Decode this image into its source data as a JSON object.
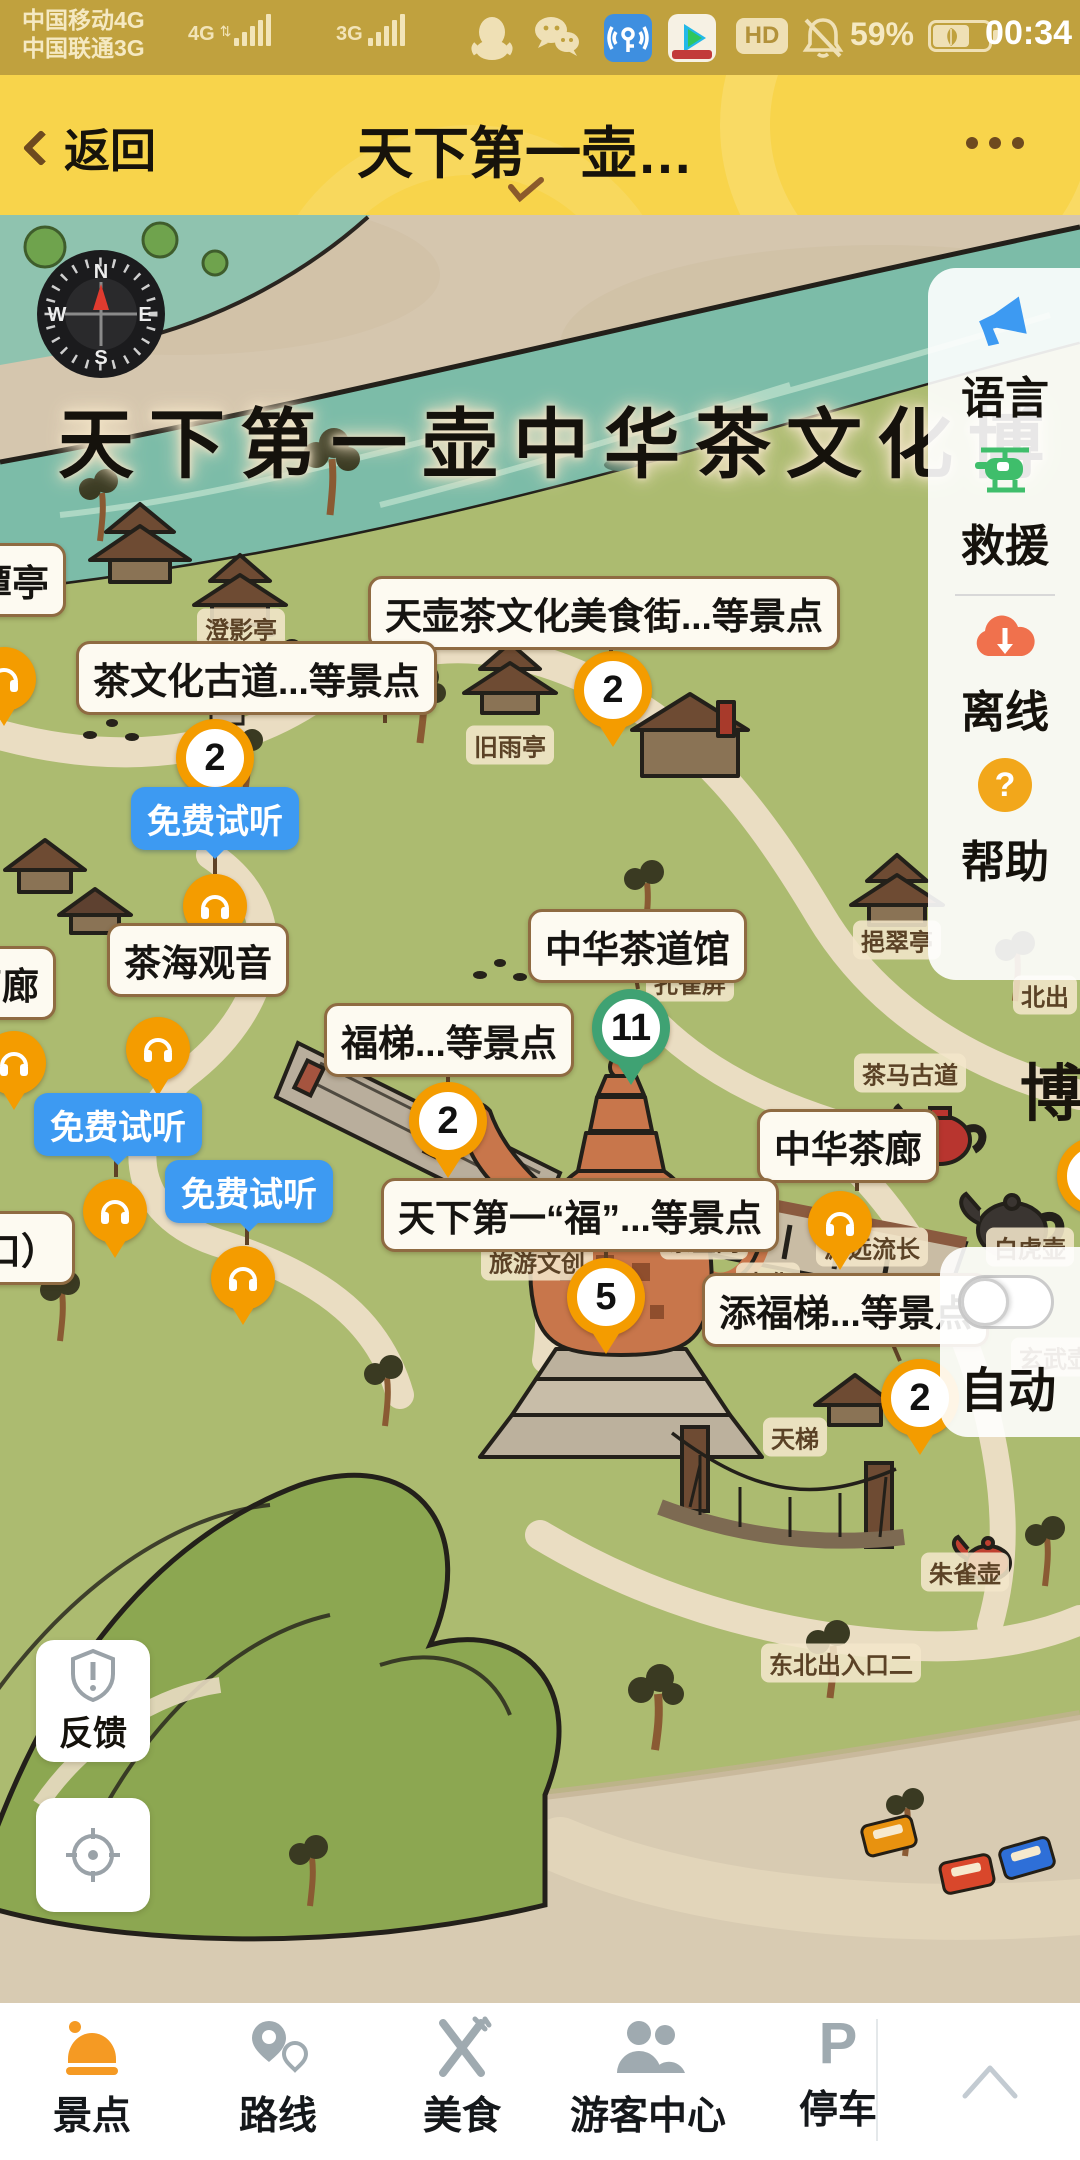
{
  "status_bar": {
    "carrier_line1": "中国移动4G",
    "carrier_line2": "中国联通3G",
    "network_badge_1": "4G",
    "network_badge_2": "3G",
    "hd_label": "HD",
    "battery_percent": "59%",
    "time": "00:34",
    "app_icons": [
      "qq",
      "wechat",
      "wifi-key",
      "tencent-video"
    ]
  },
  "nav_bar": {
    "back_label": "返回",
    "title": "天下第一壶…"
  },
  "map": {
    "big_title": "天下第一壶中华茶文化博",
    "ghost_char": "博",
    "large_labels": [
      {
        "text": "天壶茶文化美食街...等景点"
      },
      {
        "text": "茶文化古道...等景点"
      },
      {
        "text": "茶海观音"
      },
      {
        "text": "中华茶道馆"
      },
      {
        "text": "福梯...等景点"
      },
      {
        "text": "中华茶廊"
      },
      {
        "text": "天下第一“福”...等景点"
      },
      {
        "text": "添福梯...等景点"
      },
      {
        "text": "入口）"
      },
      {
        "text": "潭亭"
      },
      {
        "text": "茗廊"
      }
    ],
    "small_labels": [
      {
        "text": "澄影亭"
      },
      {
        "text": "旧雨亭"
      },
      {
        "text": "孔雀屏"
      },
      {
        "text": "挹翠亭"
      },
      {
        "text": "北出"
      },
      {
        "text": "茶马古道"
      },
      {
        "text": "源远流长"
      },
      {
        "text": "白虎壶"
      },
      {
        "text": "玄武壶"
      },
      {
        "text": "天梯"
      },
      {
        "text": "朱雀壶"
      },
      {
        "text": "东北出入口二"
      },
      {
        "text": "茶宝阁"
      },
      {
        "text": "旅游文创"
      },
      {
        "text": "中华"
      }
    ],
    "pins": [
      {
        "value": "2",
        "color": "#F49C00"
      },
      {
        "value": "2",
        "color": "#F49C00"
      },
      {
        "value": "2",
        "color": "#F49C00"
      },
      {
        "value": "11",
        "color": "#3FA273"
      },
      {
        "value": "5",
        "color": "#F49C00"
      },
      {
        "value": "2",
        "color": "#F49C00"
      }
    ],
    "audio_badges": [
      {
        "text": "免费试听"
      },
      {
        "text": "免费试听"
      },
      {
        "text": "免费试听"
      }
    ]
  },
  "side_panel": {
    "items": [
      {
        "label": "语言",
        "icon": "megaphone-icon",
        "icon_color": "#3D9AF2"
      },
      {
        "label": "救援",
        "icon": "helicopter-icon",
        "icon_color": "#3FBE6B"
      },
      {
        "label": "离线",
        "icon": "cloud-download-icon",
        "icon_color": "#F0714D"
      },
      {
        "label": "帮助",
        "icon": "question-icon",
        "icon_color": "#F2A71B"
      }
    ],
    "auto": {
      "label": "自动",
      "toggle_state": "off"
    }
  },
  "map_controls": {
    "feedback_label": "反馈"
  },
  "bottom_nav": {
    "items": [
      {
        "label": "景点",
        "active": true,
        "icon_color": "#F59A23"
      },
      {
        "label": "路线",
        "active": false,
        "icon_color": "#9FAAB0"
      },
      {
        "label": "美食",
        "active": false,
        "icon_color": "#9FAAB0"
      },
      {
        "label": "游客中心",
        "active": false,
        "icon_color": "#9FAAB0"
      },
      {
        "label": "停车",
        "active": false,
        "icon_color": "#9FAAB0"
      }
    ]
  },
  "colors": {
    "status_bar_bg": "#C0A13E",
    "nav_bar_bg": "#F8D44B",
    "pin_orange": "#F49C00",
    "pin_green": "#3FA273",
    "audio_badge_blue": "#3D9AF2",
    "river": "#7CBCA8",
    "land_green": "#ACBB70",
    "parchment": "#D5C6AE"
  }
}
